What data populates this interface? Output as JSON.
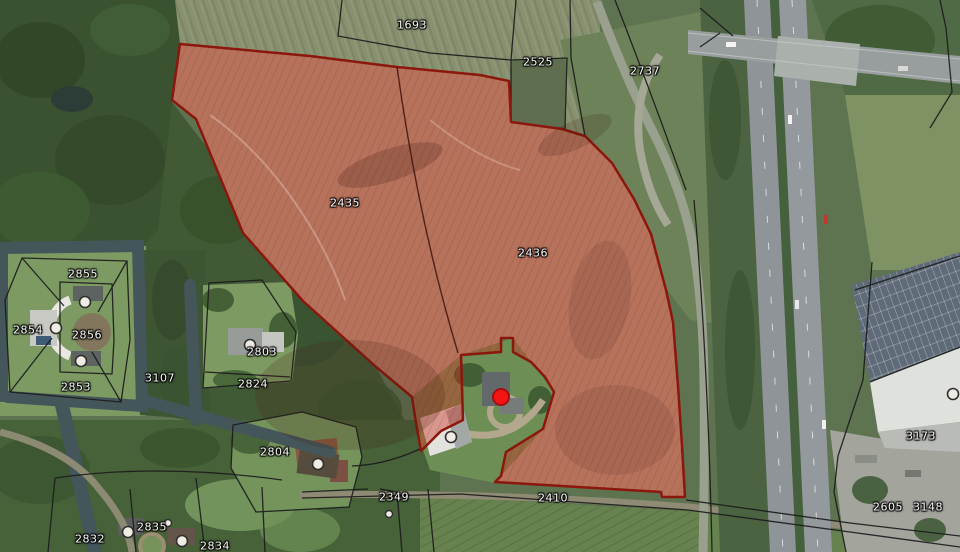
{
  "map": {
    "type": "cadastral-aerial-parcel-map",
    "selected_parcel_ids": [
      "2435",
      "2436"
    ],
    "selection_style": {
      "fill": "#cd2d20",
      "stroke": "#8c170c"
    },
    "location_marker": {
      "x": 501,
      "y": 397,
      "color": "#f51414",
      "ring": "#a50f0f"
    },
    "parcel_labels": [
      {
        "id": "1693",
        "x": 412,
        "y": 25
      },
      {
        "id": "2525",
        "x": 538,
        "y": 62
      },
      {
        "id": "2737",
        "x": 645,
        "y": 71
      },
      {
        "id": "2435",
        "x": 345,
        "y": 203
      },
      {
        "id": "2436",
        "x": 533,
        "y": 253
      },
      {
        "id": "2855",
        "x": 83,
        "y": 274
      },
      {
        "id": "2854",
        "x": 28,
        "y": 330
      },
      {
        "id": "2856",
        "x": 87,
        "y": 335
      },
      {
        "id": "2803",
        "x": 262,
        "y": 352
      },
      {
        "id": "3107",
        "x": 160,
        "y": 378
      },
      {
        "id": "2824",
        "x": 253,
        "y": 384
      },
      {
        "id": "2853",
        "x": 76,
        "y": 387
      },
      {
        "id": "2804",
        "x": 275,
        "y": 452
      },
      {
        "id": "2349",
        "x": 394,
        "y": 497
      },
      {
        "id": "2410",
        "x": 553,
        "y": 498
      },
      {
        "id": "3173",
        "x": 921,
        "y": 436
      },
      {
        "id": "2605",
        "x": 888,
        "y": 507
      },
      {
        "id": "3148",
        "x": 928,
        "y": 507
      },
      {
        "id": "2835",
        "x": 152,
        "y": 527
      },
      {
        "id": "2832",
        "x": 90,
        "y": 539
      },
      {
        "id": "2834",
        "x": 215,
        "y": 546
      }
    ],
    "building_markers": [
      {
        "x": 85,
        "y": 302
      },
      {
        "x": 56,
        "y": 328
      },
      {
        "x": 81,
        "y": 361
      },
      {
        "x": 250,
        "y": 345
      },
      {
        "x": 318,
        "y": 464
      },
      {
        "x": 451,
        "y": 437
      },
      {
        "x": 128,
        "y": 532
      },
      {
        "x": 182,
        "y": 541
      },
      {
        "x": 953,
        "y": 394
      }
    ],
    "dot_markers": [
      {
        "x": 389,
        "y": 514
      },
      {
        "x": 168,
        "y": 523
      }
    ]
  }
}
